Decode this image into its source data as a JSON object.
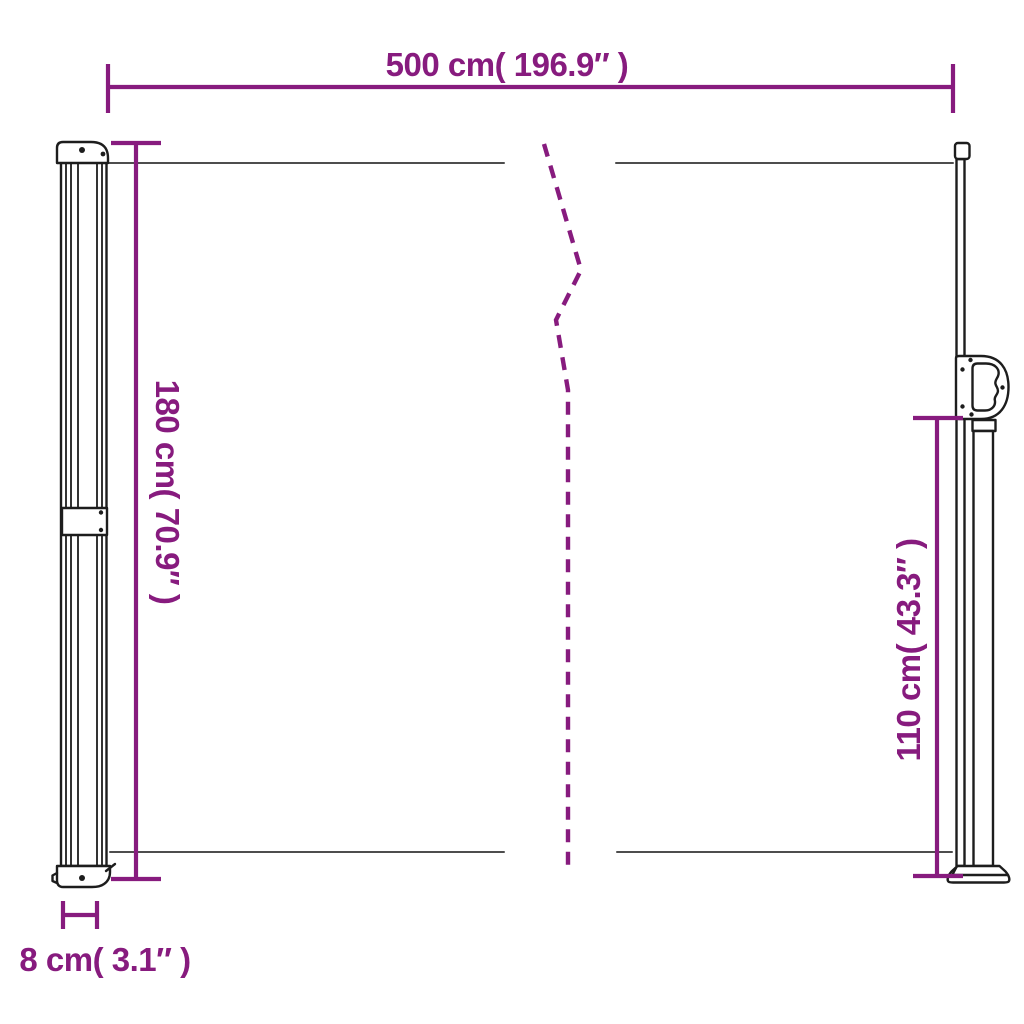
{
  "dims": {
    "width": {
      "label": "500 cm( 196.9″ )",
      "cm": 500,
      "inches": 196.9
    },
    "height": {
      "label": "180 cm( 70.9″ )",
      "cm": 180,
      "inches": 70.9
    },
    "pole_height": {
      "label": "110 cm( 43.3″ )",
      "cm": 110,
      "inches": 43.3
    },
    "depth": {
      "label": "8 cm( 3.1″ )",
      "cm": 8,
      "inches": 3.1
    }
  },
  "colors": {
    "dimension_accent": "#871b7e",
    "drawing_outline": "#1d1d1d",
    "fabric_edge": "#4d4d4d",
    "background": "#ffffff"
  }
}
